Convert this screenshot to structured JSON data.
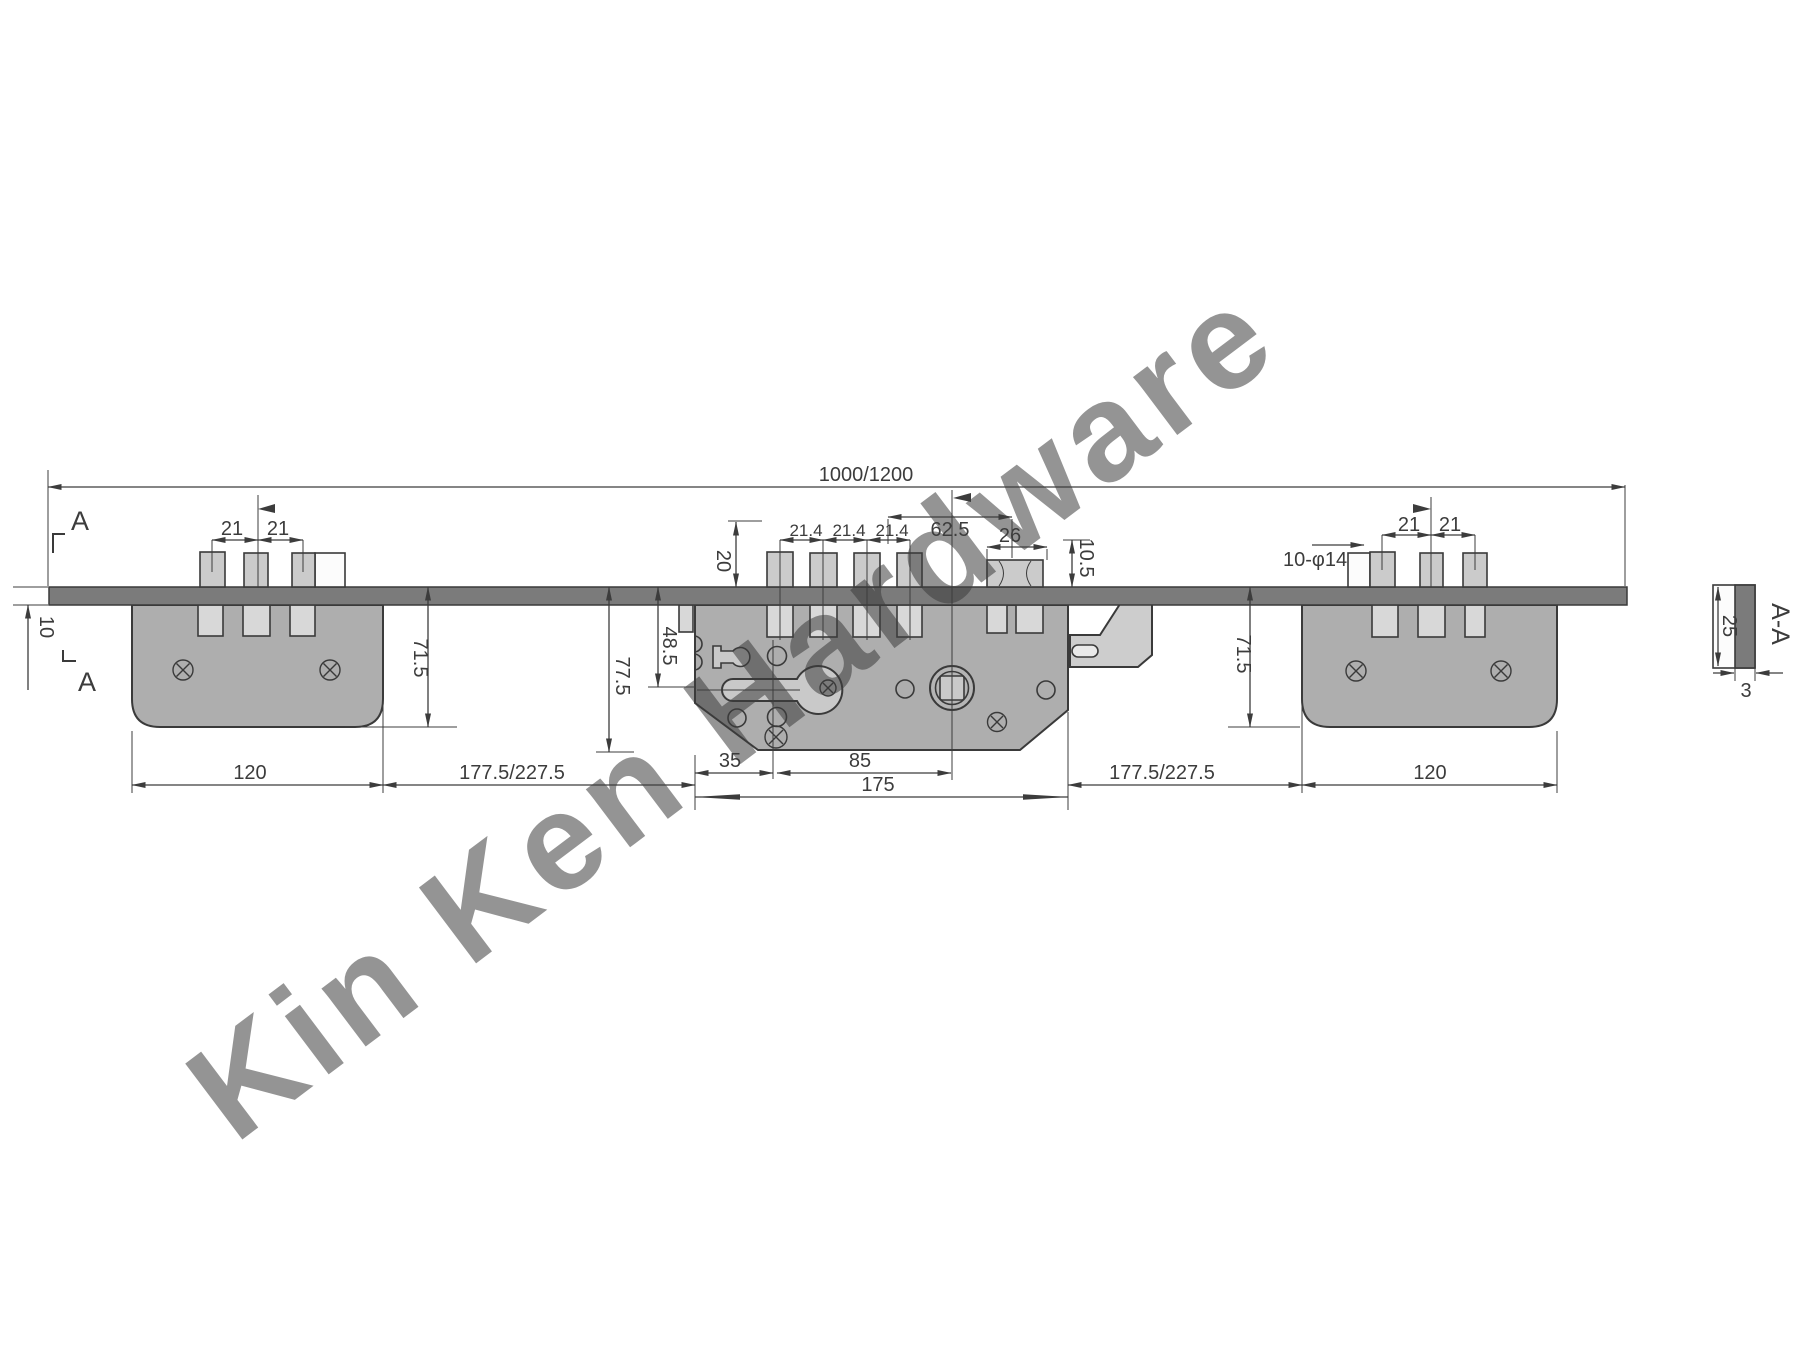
{
  "watermark": "Kin Ken Hardware",
  "dims": {
    "overall": "1000/1200",
    "left_sp1": "21",
    "left_sp2": "21",
    "plate_offset": "10",
    "left_height": "71.5",
    "left_width": "120",
    "span_left": "177.5/227.5",
    "span_right": "177.5/227.5",
    "bolt_throw": "20",
    "c_sp1": "21.4",
    "c_sp2": "21.4",
    "c_sp3": "21.4",
    "latch_offset": "62.5",
    "latch_width": "26",
    "latch_lift": "10.5",
    "center_height": "77.5",
    "axis_height": "48.5",
    "backset": "35",
    "axis_span": "85",
    "center_width": "175",
    "holes_note": "10-φ14",
    "right_sp1": "21",
    "right_sp2": "21",
    "right_height": "71.5",
    "right_width": "120",
    "section_height": "25",
    "section_thickness": "3",
    "section_label": "A-A",
    "cut_mark_top": "A",
    "cut_mark_bottom": "A"
  }
}
